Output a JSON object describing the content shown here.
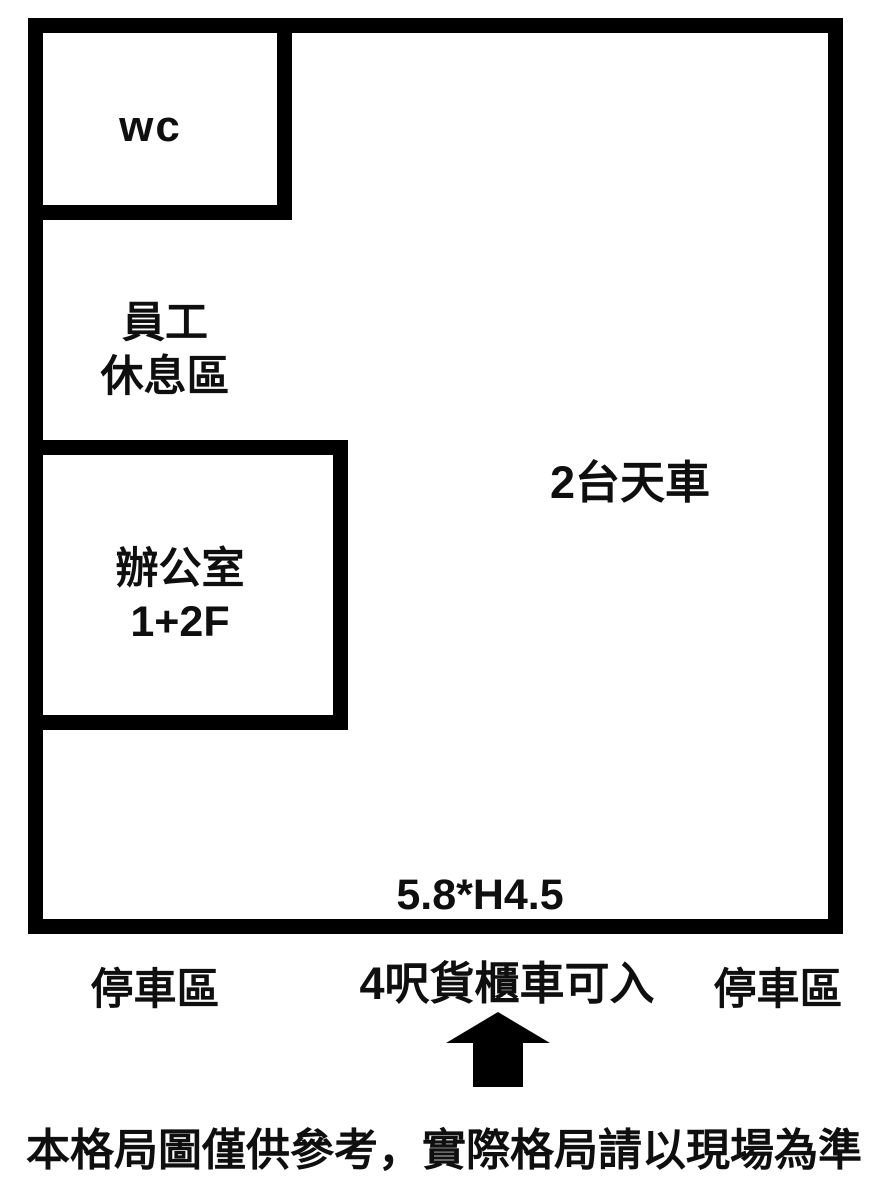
{
  "plan": {
    "rooms": {
      "wc": {
        "label": "wc"
      },
      "staff_rest_area": {
        "lines": [
          "員工",
          "休息區"
        ]
      },
      "office": {
        "lines": [
          "辦公室",
          "1+2F"
        ]
      }
    },
    "annotations": {
      "crane": "2台天車",
      "door_dimension": "5.8*H4.5"
    },
    "outside": {
      "parking_left": "停車區",
      "entrance_note": "4呎貨櫃車可入",
      "parking_right": "停車區",
      "arrow_icon": "up-arrow"
    },
    "disclaimer": "本格局圖僅供參考，實際格局請以現場為準",
    "colors": {
      "wall": "#000000",
      "background": "#ffffff",
      "text": "#0f0f0f"
    }
  }
}
